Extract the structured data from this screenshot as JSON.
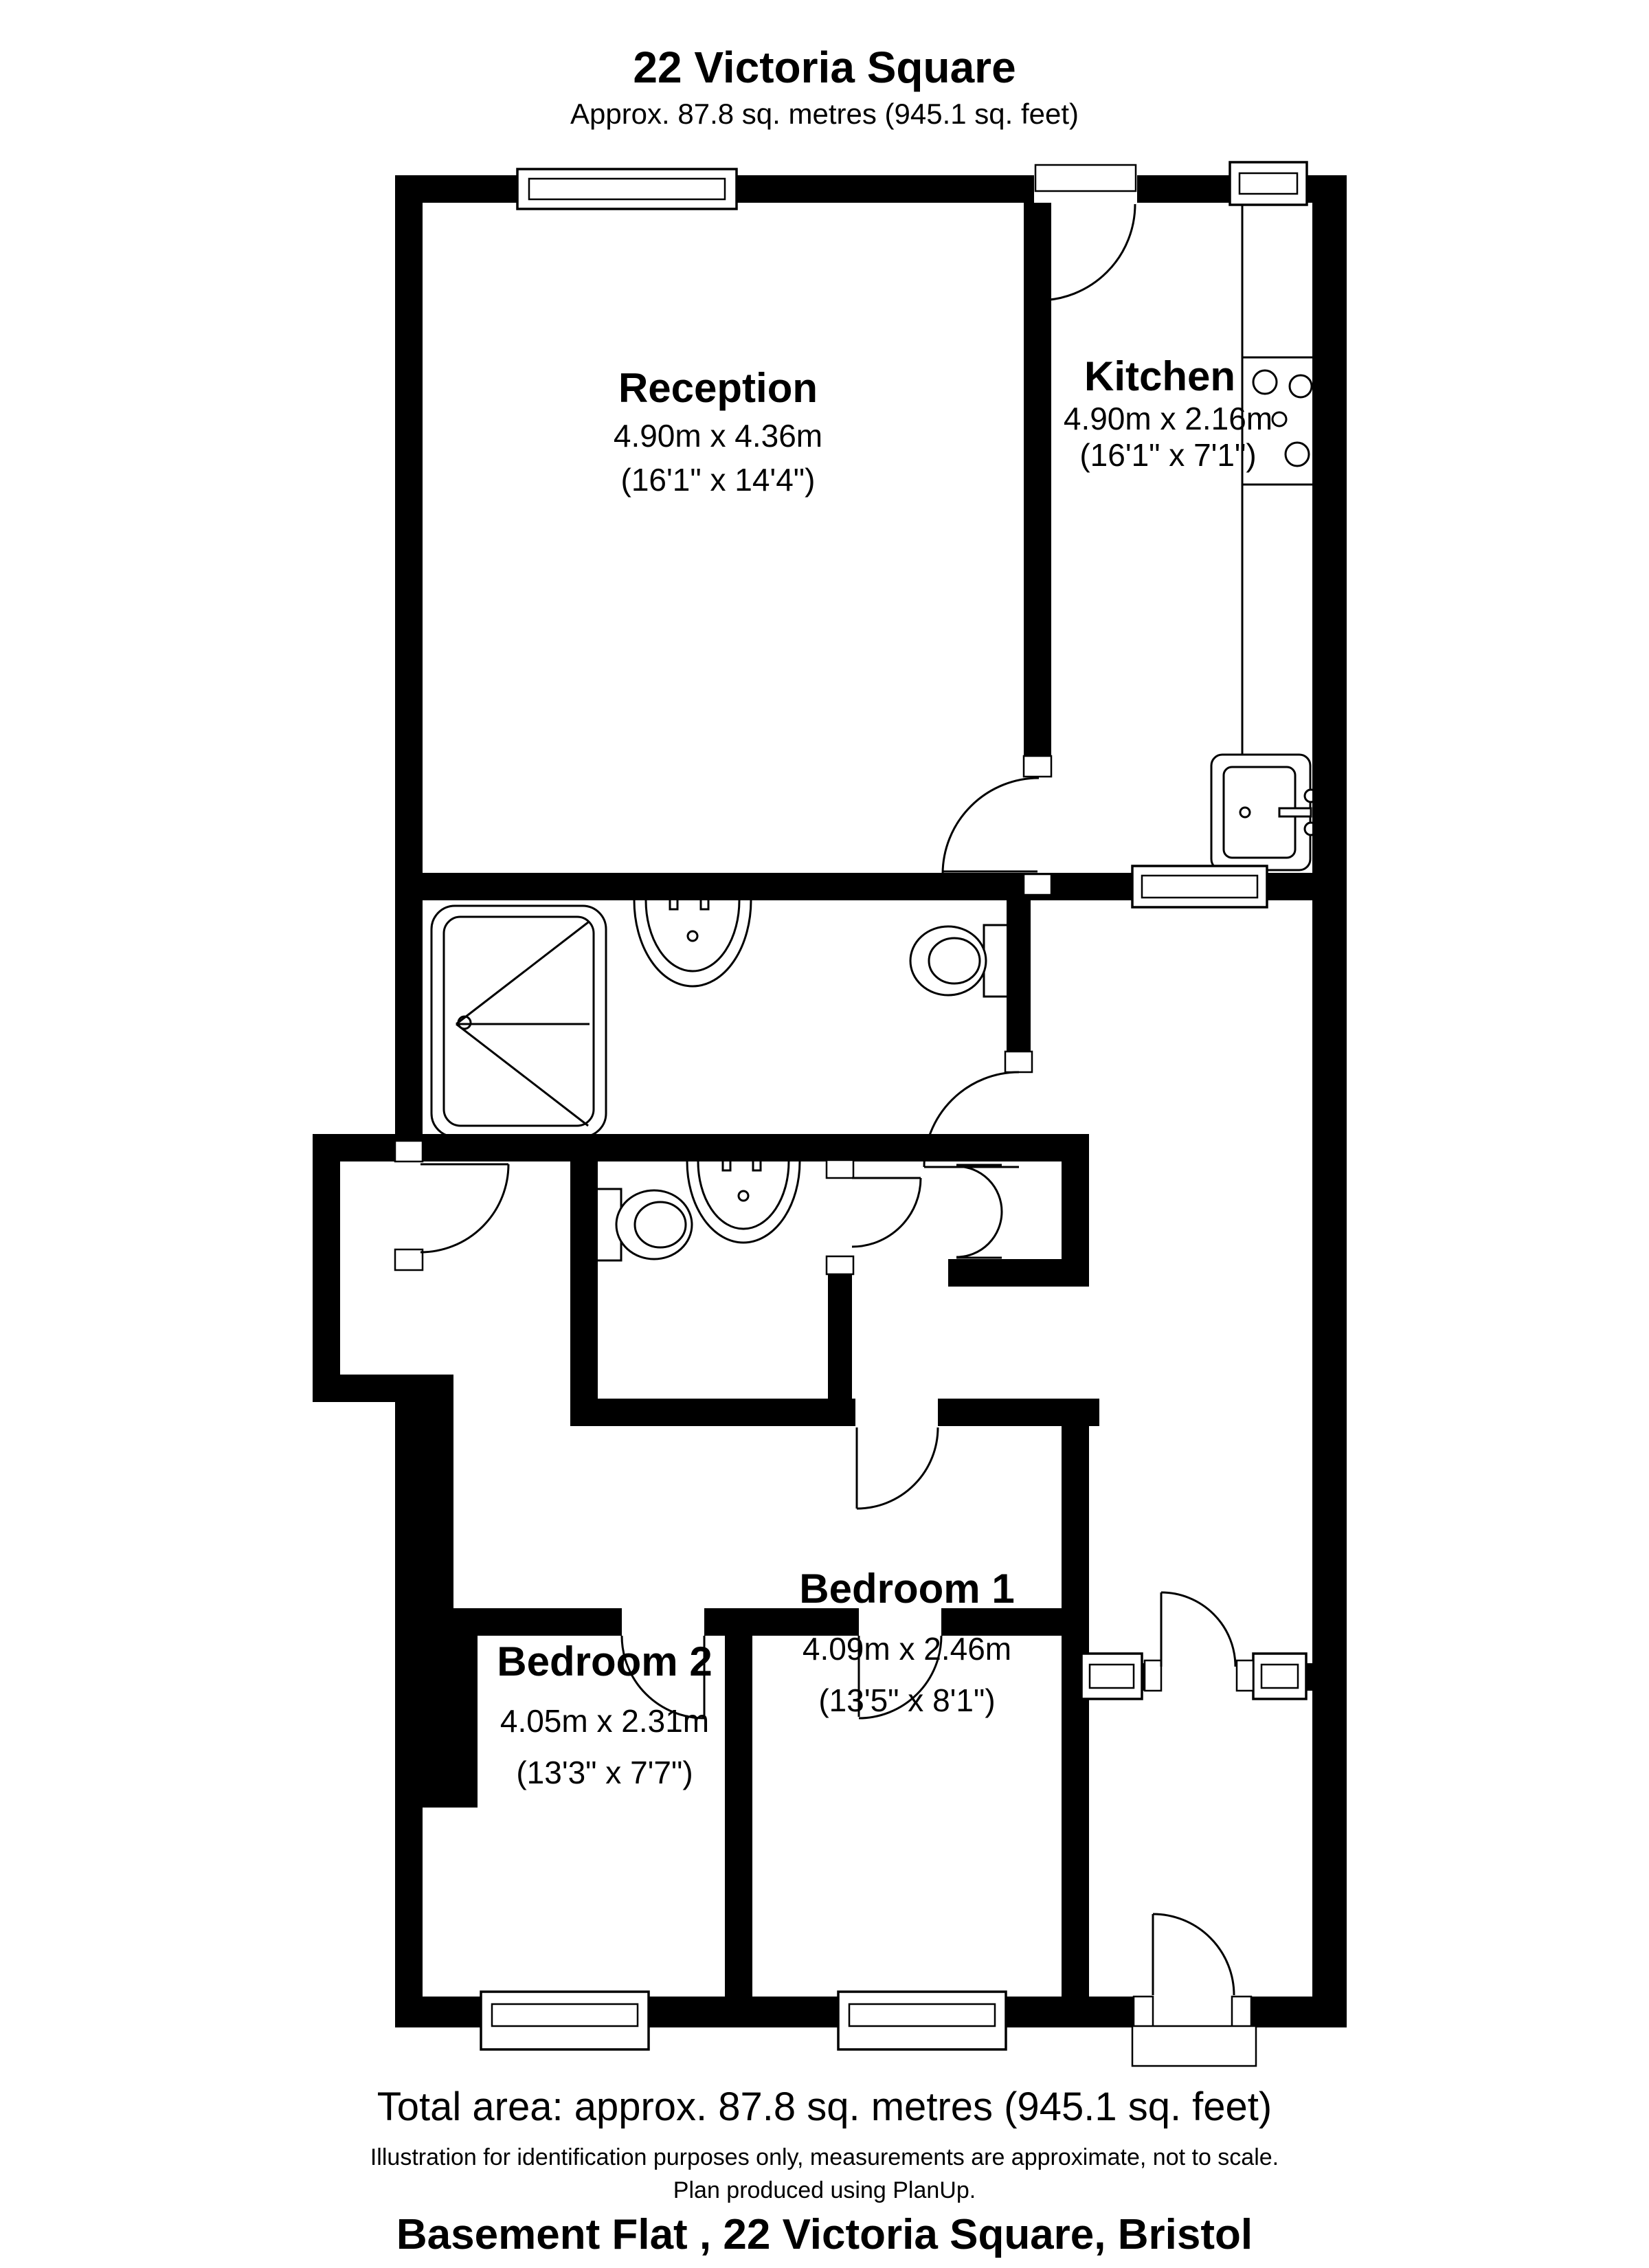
{
  "header": {
    "title": "22 Victoria Square",
    "subtitle": "Approx. 87.8 sq. metres (945.1 sq. feet)"
  },
  "rooms": {
    "reception": {
      "name": "Reception",
      "dims_metric": "4.90m x 4.36m",
      "dims_imperial": "(16'1\" x 14'4\")"
    },
    "kitchen": {
      "name": "Kitchen",
      "dims_metric": "4.90m x 2.16m",
      "dims_imperial": "(16'1\" x 7'1\")"
    },
    "bedroom1": {
      "name": "Bedroom 1",
      "dims_metric": "4.09m x 2.46m",
      "dims_imperial": "(13'5\" x 8'1\")"
    },
    "bedroom2": {
      "name": "Bedroom 2",
      "dims_metric": "4.05m x 2.31m",
      "dims_imperial": "(13'3\" x 7'7\")"
    }
  },
  "footer": {
    "total_area": "Total area: approx. 87.8 sq. metres (945.1 sq. feet)",
    "disclaimer_line1": "Illustration for identification purposes only, measurements are approximate, not to scale.",
    "disclaimer_line2": "Plan produced using PlanUp.",
    "address": "Basement Flat , 22 Victoria Square, Bristol"
  },
  "colors": {
    "wall": "#000000",
    "background": "#ffffff",
    "line": "#000000"
  }
}
